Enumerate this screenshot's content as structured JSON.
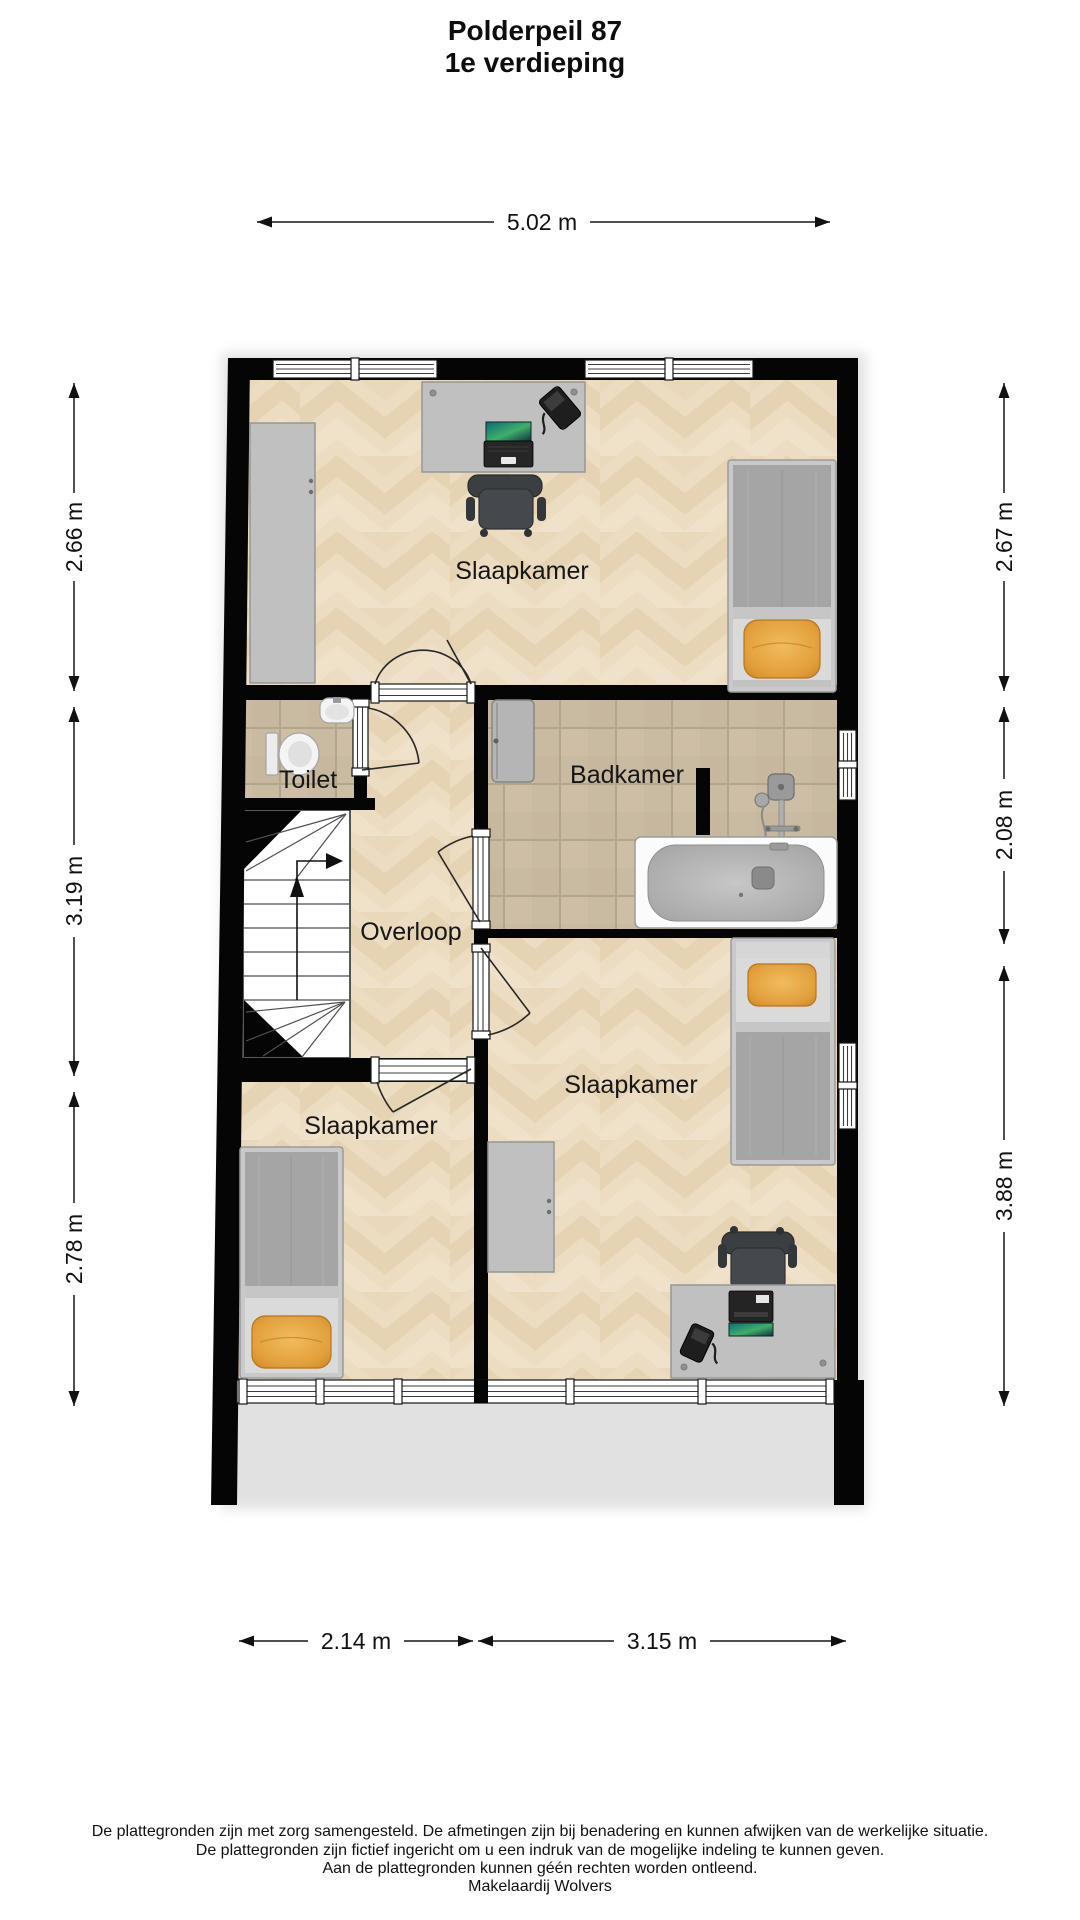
{
  "title": {
    "line1": "Polderpeil 87",
    "line2": "1e verdieping"
  },
  "rooms": {
    "bedroom_top": "Slaapkamer",
    "toilet": "Toilet",
    "bathroom": "Badkamer",
    "landing": "Overloop",
    "bedroom_left": "Slaapkamer",
    "bedroom_right": "Slaapkamer"
  },
  "dimensions": {
    "top": "5.02 m",
    "left": [
      "2.66 m",
      "3.19 m",
      "2.78 m"
    ],
    "right": [
      "2.67 m",
      "2.08 m",
      "3.88 m"
    ],
    "bottom": [
      "2.14 m",
      "3.15 m"
    ]
  },
  "footer": {
    "line1": "De plattegronden zijn met zorg samengesteld. De afmetingen zijn bij benadering en kunnen afwijken van de werkelijke situatie.",
    "line2": "De plattegronden zijn fictief ingericht om u een indruk van de mogelijke indeling te kunnen geven.",
    "line3": "Aan de plattegronden kunnen géén rechten worden ontleend.",
    "line4": "Makelaardij Wolvers"
  },
  "colors": {
    "wall": "#050505",
    "parquet": "#ecdcc2",
    "tile": "#c9bba2",
    "furniture": "#c0c0c0",
    "pillow": "#e2a03c"
  }
}
